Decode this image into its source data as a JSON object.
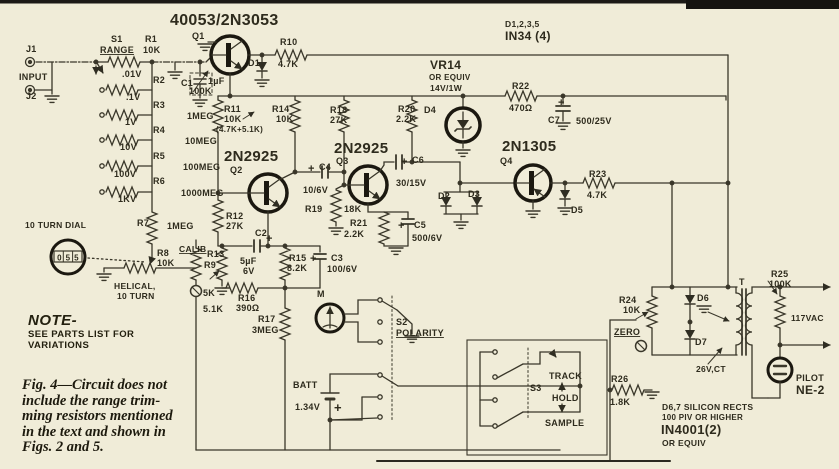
{
  "colors": {
    "paper": "#f0ecd8",
    "ink": "#3a372a",
    "ink_text": "#2e2b1d",
    "heavy": "#1b1810"
  },
  "note": {
    "title": "NOTE-",
    "lines": [
      "SEE PARTS LIST FOR",
      "VARIATIONS"
    ]
  },
  "caption": {
    "lines": [
      "Fig. 4—Circuit does not",
      "include the range trim-",
      "ming resistors mentioned",
      "in the text and shown in",
      "Figs. 2 and 5."
    ]
  },
  "dial": {
    "title": "10 TURN DIAL",
    "digits": [
      "0",
      "5",
      "5"
    ]
  },
  "labels": [
    {
      "id": "q1-part",
      "t": "40053/2N3053",
      "x": 170,
      "y": 25,
      "s": 16
    },
    {
      "id": "q1",
      "t": "Q1",
      "x": 192,
      "y": 39
    },
    {
      "id": "d-group",
      "t": "D1,2,3,5",
      "x": 505,
      "y": 27,
      "s": 8.5
    },
    {
      "id": "d-group-type",
      "t": "IN34 (4)",
      "x": 505,
      "y": 40,
      "s": 12
    },
    {
      "id": "j1",
      "t": "J1",
      "x": 26,
      "y": 52
    },
    {
      "id": "input",
      "t": "INPUT",
      "x": 19,
      "y": 80
    },
    {
      "id": "j2",
      "t": "J2",
      "x": 26,
      "y": 99
    },
    {
      "id": "s1",
      "t": "S1",
      "x": 111,
      "y": 42
    },
    {
      "id": "range",
      "t": "RANGE",
      "x": 100,
      "y": 53,
      "u": true
    },
    {
      "id": "r1",
      "t": "R1",
      "x": 145,
      "y": 42
    },
    {
      "id": "r1-val",
      "t": "10K",
      "x": 143,
      "y": 53
    },
    {
      "id": "tap-01v",
      "t": ".01V",
      "x": 122,
      "y": 77
    },
    {
      "id": "r2",
      "t": "R2",
      "x": 153,
      "y": 83
    },
    {
      "id": "r2-val",
      "t": "100K",
      "x": 189,
      "y": 94
    },
    {
      "id": "tap-p1v",
      "t": ".1V",
      "x": 126,
      "y": 100
    },
    {
      "id": "r3",
      "t": "R3",
      "x": 153,
      "y": 108
    },
    {
      "id": "r3-val",
      "t": "1MEG",
      "x": 187,
      "y": 119
    },
    {
      "id": "tap-1v",
      "t": "1V",
      "x": 125,
      "y": 125
    },
    {
      "id": "r4",
      "t": "R4",
      "x": 153,
      "y": 133
    },
    {
      "id": "r4-val",
      "t": "10MEG",
      "x": 185,
      "y": 144
    },
    {
      "id": "tap-10v",
      "t": "10V",
      "x": 120,
      "y": 150
    },
    {
      "id": "r5",
      "t": "R5",
      "x": 153,
      "y": 159
    },
    {
      "id": "r5-val",
      "t": "100MEG",
      "x": 183,
      "y": 170
    },
    {
      "id": "tap-100v",
      "t": "100V",
      "x": 114,
      "y": 177
    },
    {
      "id": "r6",
      "t": "R6",
      "x": 153,
      "y": 184
    },
    {
      "id": "r6-val",
      "t": "1000MEG",
      "x": 181,
      "y": 196
    },
    {
      "id": "tap-1kv",
      "t": "1KV",
      "x": 118,
      "y": 202
    },
    {
      "id": "r7",
      "t": "R7",
      "x": 137,
      "y": 226
    },
    {
      "id": "r7-val",
      "t": "1MEG",
      "x": 167,
      "y": 229
    },
    {
      "id": "dial-title",
      "t": "10 TURN DIAL",
      "x": 25,
      "y": 228,
      "s": 8.5
    },
    {
      "id": "r8",
      "t": "R8",
      "x": 157,
      "y": 256
    },
    {
      "id": "r8-val",
      "t": "10K",
      "x": 157,
      "y": 266
    },
    {
      "id": "helical-1",
      "t": "HELICAL,",
      "x": 114,
      "y": 289,
      "s": 8.5
    },
    {
      "id": "helical-2",
      "t": "10 TURN",
      "x": 117,
      "y": 299,
      "s": 8.5
    },
    {
      "id": "calib",
      "t": "CALIB",
      "x": 179,
      "y": 252,
      "u": true,
      "s": 8.5
    },
    {
      "id": "r9",
      "t": "R9",
      "x": 204,
      "y": 268
    },
    {
      "id": "r9-val",
      "t": "5K",
      "x": 203,
      "y": 296
    },
    {
      "id": "r13",
      "t": "R13",
      "x": 207,
      "y": 257
    },
    {
      "id": "r13-val",
      "t": "5.1K",
      "x": 203,
      "y": 312
    },
    {
      "id": "r12",
      "t": "R12",
      "x": 226,
      "y": 219
    },
    {
      "id": "r12-val",
      "t": "27K",
      "x": 226,
      "y": 229
    },
    {
      "id": "c2",
      "t": "C2",
      "x": 255,
      "y": 236
    },
    {
      "id": "c2-plus",
      "t": "+",
      "x": 266,
      "y": 242,
      "s": 11
    },
    {
      "id": "c2-val1",
      "t": "5µF",
      "x": 240,
      "y": 264
    },
    {
      "id": "c2-val2",
      "t": "6V",
      "x": 243,
      "y": 274
    },
    {
      "id": "r15",
      "t": "R15",
      "x": 289,
      "y": 261
    },
    {
      "id": "r15-val",
      "t": "8.2K",
      "x": 287,
      "y": 271
    },
    {
      "id": "c3",
      "t": "C3",
      "x": 331,
      "y": 261
    },
    {
      "id": "c3-plus",
      "t": "+",
      "x": 310,
      "y": 262,
      "s": 11
    },
    {
      "id": "c3-val",
      "t": "100/6V",
      "x": 327,
      "y": 272
    },
    {
      "id": "r16",
      "t": "R16",
      "x": 238,
      "y": 301
    },
    {
      "id": "r16-val",
      "t": "390Ω",
      "x": 236,
      "y": 311
    },
    {
      "id": "r17",
      "t": "R17",
      "x": 258,
      "y": 322
    },
    {
      "id": "r17-val",
      "t": "3MEG",
      "x": 252,
      "y": 333
    },
    {
      "id": "q2-part",
      "t": "2N2925",
      "x": 224,
      "y": 161,
      "s": 15
    },
    {
      "id": "q2",
      "t": "Q2",
      "x": 230,
      "y": 173
    },
    {
      "id": "c4",
      "t": "C4",
      "x": 319,
      "y": 170
    },
    {
      "id": "c4-plus",
      "t": "+",
      "x": 308,
      "y": 172,
      "s": 11
    },
    {
      "id": "c4-val",
      "t": "10/6V",
      "x": 303,
      "y": 193
    },
    {
      "id": "q3-part",
      "t": "2N2925",
      "x": 334,
      "y": 153,
      "s": 15
    },
    {
      "id": "q3",
      "t": "Q3",
      "x": 336,
      "y": 164
    },
    {
      "id": "r19",
      "t": "R19",
      "x": 305,
      "y": 212
    },
    {
      "id": "r19-val",
      "t": "18K",
      "x": 344,
      "y": 212
    },
    {
      "id": "c6",
      "t": "C6",
      "x": 412,
      "y": 163
    },
    {
      "id": "c6-plus",
      "t": "+",
      "x": 401,
      "y": 165,
      "s": 11
    },
    {
      "id": "c6-val",
      "t": "30/15V",
      "x": 396,
      "y": 186
    },
    {
      "id": "r21",
      "t": "R21",
      "x": 350,
      "y": 226
    },
    {
      "id": "r21-val",
      "t": "2.2K",
      "x": 344,
      "y": 237
    },
    {
      "id": "c5",
      "t": "C5",
      "x": 414,
      "y": 228
    },
    {
      "id": "c5-plus",
      "t": "+",
      "x": 398,
      "y": 229,
      "s": 11
    },
    {
      "id": "c5-val",
      "t": "500/6V",
      "x": 412,
      "y": 241
    },
    {
      "id": "d2",
      "t": "D2",
      "x": 438,
      "y": 199
    },
    {
      "id": "d3",
      "t": "D3",
      "x": 468,
      "y": 197
    },
    {
      "id": "r11",
      "t": "R11",
      "x": 224,
      "y": 112
    },
    {
      "id": "r11-val",
      "t": "10K",
      "x": 224,
      "y": 122
    },
    {
      "id": "r11-note",
      "t": "(4.7K+5.1K)",
      "x": 216,
      "y": 132,
      "s": 8
    },
    {
      "id": "r14",
      "t": "R14",
      "x": 272,
      "y": 112
    },
    {
      "id": "r14-val",
      "t": "10K",
      "x": 276,
      "y": 122
    },
    {
      "id": "r18",
      "t": "R18",
      "x": 330,
      "y": 113
    },
    {
      "id": "r18-val",
      "t": "27K",
      "x": 330,
      "y": 123
    },
    {
      "id": "r20",
      "t": "R20",
      "x": 398,
      "y": 112
    },
    {
      "id": "r20-val",
      "t": "2.2K",
      "x": 396,
      "y": 122
    },
    {
      "id": "d4",
      "t": "D4",
      "x": 424,
      "y": 113
    },
    {
      "id": "vr14",
      "t": "VR14",
      "x": 430,
      "y": 69,
      "s": 12
    },
    {
      "id": "vr14-equiv",
      "t": "OR EQUIV",
      "x": 429,
      "y": 80,
      "s": 8
    },
    {
      "id": "vr14-rating",
      "t": "14V/1W",
      "x": 430,
      "y": 91,
      "s": 8.5
    },
    {
      "id": "r10",
      "t": "R10",
      "x": 280,
      "y": 45
    },
    {
      "id": "r10-val",
      "t": "4.7K",
      "x": 278,
      "y": 67
    },
    {
      "id": "d1",
      "t": "D1",
      "x": 248,
      "y": 66
    },
    {
      "id": "c1",
      "t": "C1",
      "x": 181,
      "y": 86
    },
    {
      "id": "c1-val",
      "t": "1µF",
      "x": 208,
      "y": 84
    },
    {
      "id": "r22",
      "t": "R22",
      "x": 512,
      "y": 89
    },
    {
      "id": "r22-val",
      "t": "470Ω",
      "x": 509,
      "y": 111
    },
    {
      "id": "c7",
      "t": "C7",
      "x": 548,
      "y": 123
    },
    {
      "id": "c7-plus",
      "t": "+",
      "x": 558,
      "y": 106,
      "s": 11
    },
    {
      "id": "c7-val",
      "t": "500/25V",
      "x": 576,
      "y": 124
    },
    {
      "id": "q4-part",
      "t": "2N1305",
      "x": 502,
      "y": 151,
      "s": 15
    },
    {
      "id": "q4",
      "t": "Q4",
      "x": 500,
      "y": 164
    },
    {
      "id": "r23",
      "t": "R23",
      "x": 589,
      "y": 177
    },
    {
      "id": "r23-val",
      "t": "4.7K",
      "x": 587,
      "y": 198
    },
    {
      "id": "d5",
      "t": "D5",
      "x": 571,
      "y": 213
    },
    {
      "id": "m",
      "t": "M",
      "x": 317,
      "y": 297
    },
    {
      "id": "s2",
      "t": "S2",
      "x": 396,
      "y": 325
    },
    {
      "id": "polarity",
      "t": "POLARITY",
      "x": 396,
      "y": 336,
      "u": true
    },
    {
      "id": "batt",
      "t": "BATT",
      "x": 293,
      "y": 388
    },
    {
      "id": "batt-val",
      "t": "1.34V",
      "x": 295,
      "y": 410
    },
    {
      "id": "batt-plus",
      "t": "+",
      "x": 334,
      "y": 412,
      "s": 13
    },
    {
      "id": "s3",
      "t": "S3",
      "x": 530,
      "y": 391
    },
    {
      "id": "track",
      "t": "TRACK",
      "x": 549,
      "y": 379
    },
    {
      "id": "hold",
      "t": "HOLD",
      "x": 552,
      "y": 401
    },
    {
      "id": "sample",
      "t": "SAMPLE",
      "x": 545,
      "y": 426
    },
    {
      "id": "r24",
      "t": "R24",
      "x": 619,
      "y": 303
    },
    {
      "id": "r24-val",
      "t": "10K",
      "x": 623,
      "y": 313
    },
    {
      "id": "zero",
      "t": "ZERO",
      "x": 614,
      "y": 335,
      "u": true
    },
    {
      "id": "d6",
      "t": "D6",
      "x": 697,
      "y": 301
    },
    {
      "id": "d7",
      "t": "D7",
      "x": 695,
      "y": 345
    },
    {
      "id": "t",
      "t": "T",
      "x": 739,
      "y": 285
    },
    {
      "id": "ct",
      "t": "26V,CT",
      "x": 696,
      "y": 372,
      "s": 8.5
    },
    {
      "id": "r25",
      "t": "R25",
      "x": 771,
      "y": 277
    },
    {
      "id": "r25-val",
      "t": "100K",
      "x": 769,
      "y": 287
    },
    {
      "id": "vac",
      "t": "117VAC",
      "x": 791,
      "y": 321,
      "s": 8.5
    },
    {
      "id": "pilot",
      "t": "PILOT",
      "x": 796,
      "y": 381
    },
    {
      "id": "ne2",
      "t": "NE-2",
      "x": 796,
      "y": 394,
      "s": 12
    },
    {
      "id": "r26",
      "t": "R26",
      "x": 611,
      "y": 382
    },
    {
      "id": "r26-val",
      "t": "1.8K",
      "x": 610,
      "y": 405
    },
    {
      "id": "rects-1",
      "t": "D6,7 SILICON RECTS",
      "x": 662,
      "y": 410,
      "s": 8.5
    },
    {
      "id": "rects-2",
      "t": "100 PIV OR HIGHER",
      "x": 662,
      "y": 420,
      "s": 8
    },
    {
      "id": "rects-3",
      "t": "IN4001(2)",
      "x": 661,
      "y": 434,
      "s": 13
    },
    {
      "id": "rects-4",
      "t": "OR EQUIV",
      "x": 662,
      "y": 446,
      "s": 8.5
    }
  ]
}
